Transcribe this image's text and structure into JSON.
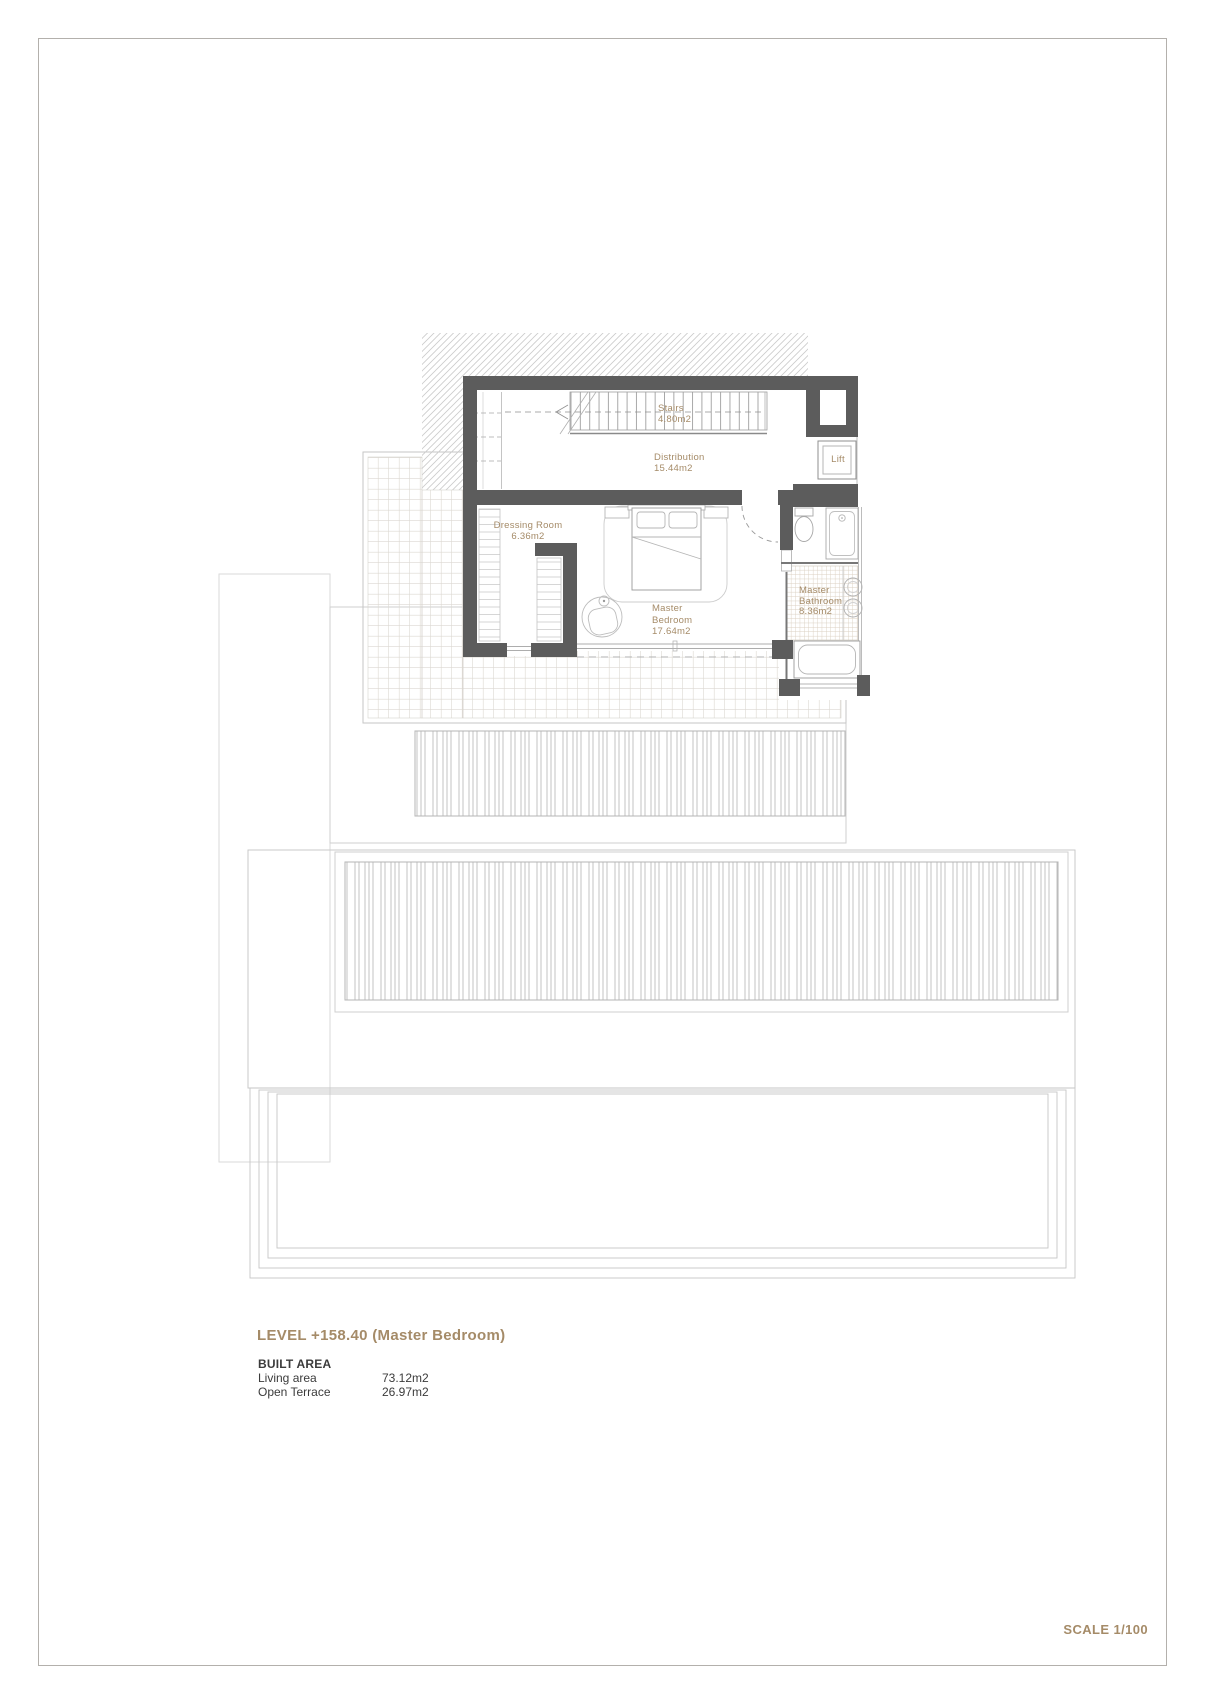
{
  "floor_plan": {
    "rooms": {
      "stairs": {
        "lines": [
          "Stairs",
          "4.80m2"
        ]
      },
      "distribution": {
        "lines": [
          "Distribution",
          "15.44m2"
        ]
      },
      "lift": {
        "lines": [
          "Lift"
        ]
      },
      "dressing": {
        "lines": [
          "Dressing Room",
          "6.36m2"
        ]
      },
      "bedroom": {
        "lines": [
          "Master",
          "Bedroom",
          "17.64m2"
        ]
      },
      "bathroom": {
        "lines": [
          "Master",
          "Bathroom",
          "8.36m2"
        ]
      }
    },
    "colors": {
      "wall": "#5c5c5c",
      "accent_text": "#a58b68"
    }
  },
  "title_block": {
    "level_title": "LEVEL +158.40 (Master Bedroom)",
    "built_area_heading": "BUILT AREA",
    "areas": [
      {
        "label": "Living area",
        "value": "73.12m2"
      },
      {
        "label": "Open Terrace",
        "value": "26.97m2"
      }
    ]
  },
  "footer": {
    "scale_label": "SCALE 1/100"
  }
}
